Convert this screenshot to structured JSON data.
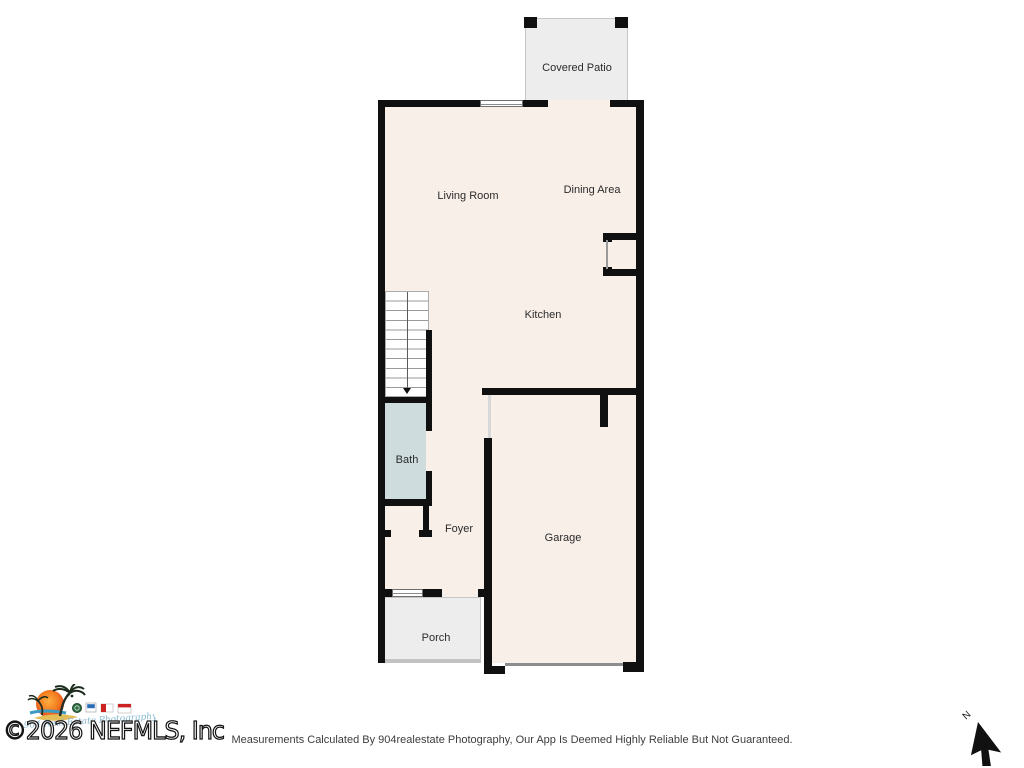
{
  "plan": {
    "rooms": {
      "covered_patio": {
        "label": "Covered Patio"
      },
      "living_room": {
        "label": "Living Room"
      },
      "dining_area": {
        "label": "Dining Area"
      },
      "kitchen": {
        "label": "Kitchen"
      },
      "bath": {
        "label": "Bath"
      },
      "foyer": {
        "label": "Foyer"
      },
      "garage": {
        "label": "Garage"
      },
      "porch": {
        "label": "Porch"
      }
    },
    "colors": {
      "wall": "#101010",
      "floor": "#f8efe9",
      "outdoor": "#ededed",
      "bath": "#cfdcdd"
    }
  },
  "footer": {
    "watermark": "©2026 NEFMLS, Inc",
    "logo_script": "904 Real Estate Photography",
    "disclaimer": "Measurements Calculated By 904realestate Photography, Our App Is Deemed Highly Reliable But Not Guaranteed.",
    "compass_label": "N"
  }
}
